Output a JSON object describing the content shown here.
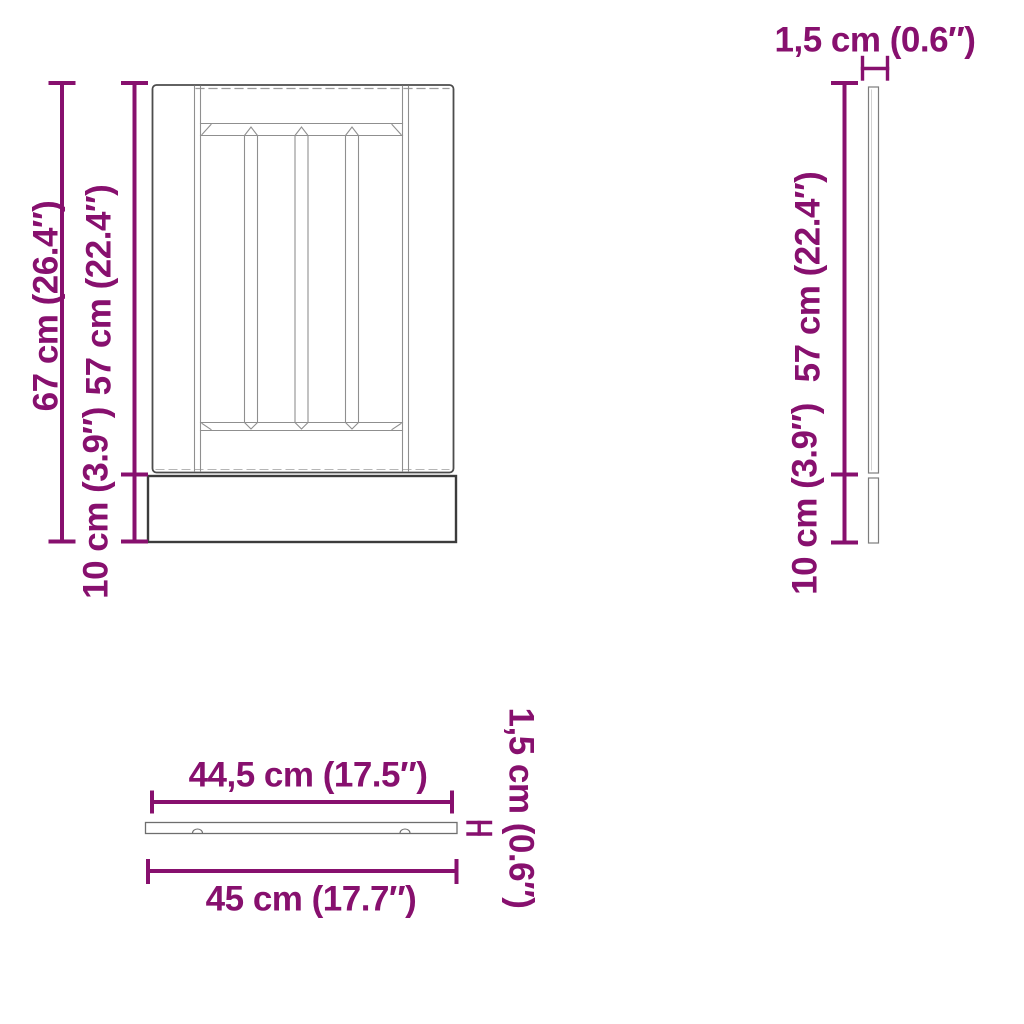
{
  "accent_color": "#87106e",
  "front_view": {
    "total_height_label": "67 cm (26.4″)",
    "door_height_label": "57 cm (22.4″)",
    "plinth_height_label": "10 cm (3.9″)"
  },
  "side_view": {
    "thickness_label": "1,5 cm (0.6″)",
    "door_height_label": "57 cm (22.4″)",
    "plinth_height_label": "10 cm (3.9″)"
  },
  "top_view": {
    "panel_width_label": "44,5 cm (17.5″)",
    "total_width_label": "45 cm (17.7″)",
    "thickness_label": "1,5 cm (0.6″)"
  }
}
